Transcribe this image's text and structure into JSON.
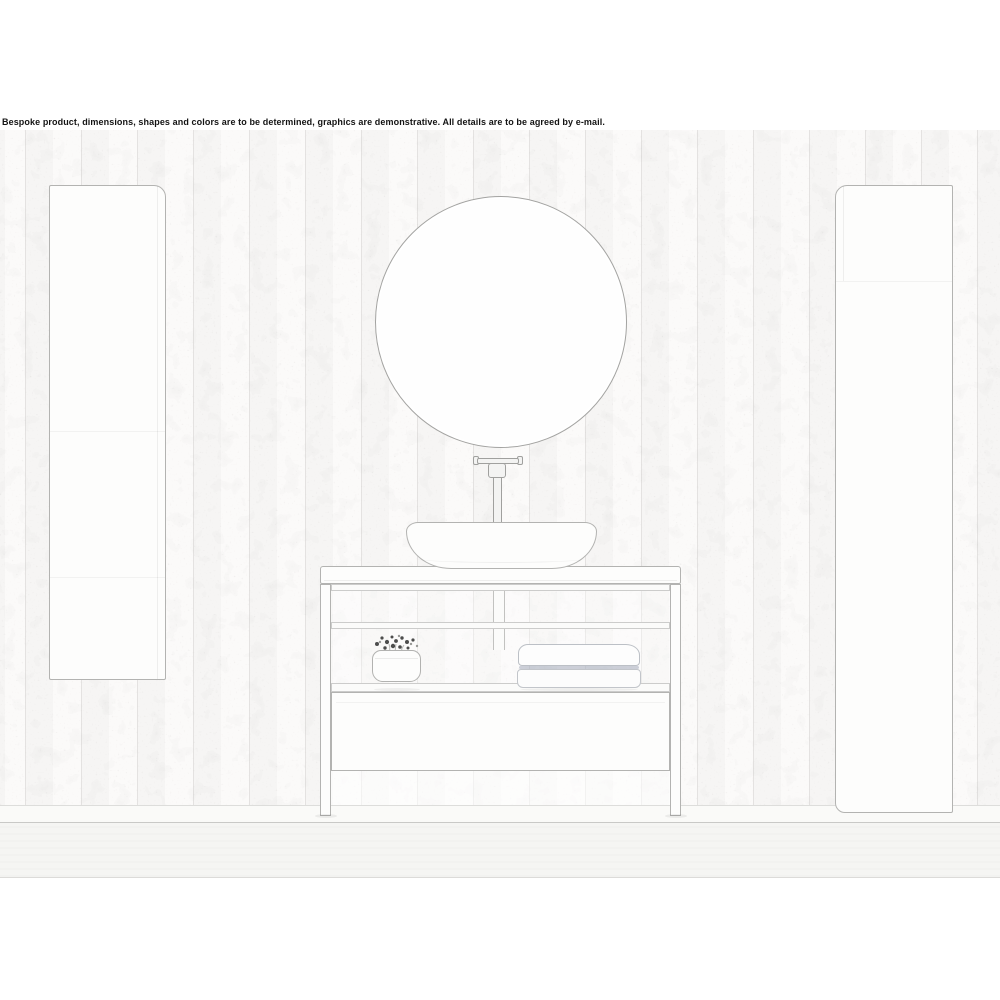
{
  "disclaimer": "Bespoke product, dimensions, shapes and colors are to be determined, graphics are demonstrative. All details are to be agreed by e-mail.",
  "palette": {
    "text": "#141414",
    "line": "#b3b3b1",
    "line-strong": "#a3a3a1",
    "line-soft": "#cccccb",
    "wall": "#fbfaf9",
    "panel": "#fdfdfc",
    "floor": "#f5f5f3",
    "skirting": "#fafaf8",
    "towel-line": "#8e99ad",
    "flower": "#4d4d4d"
  }
}
